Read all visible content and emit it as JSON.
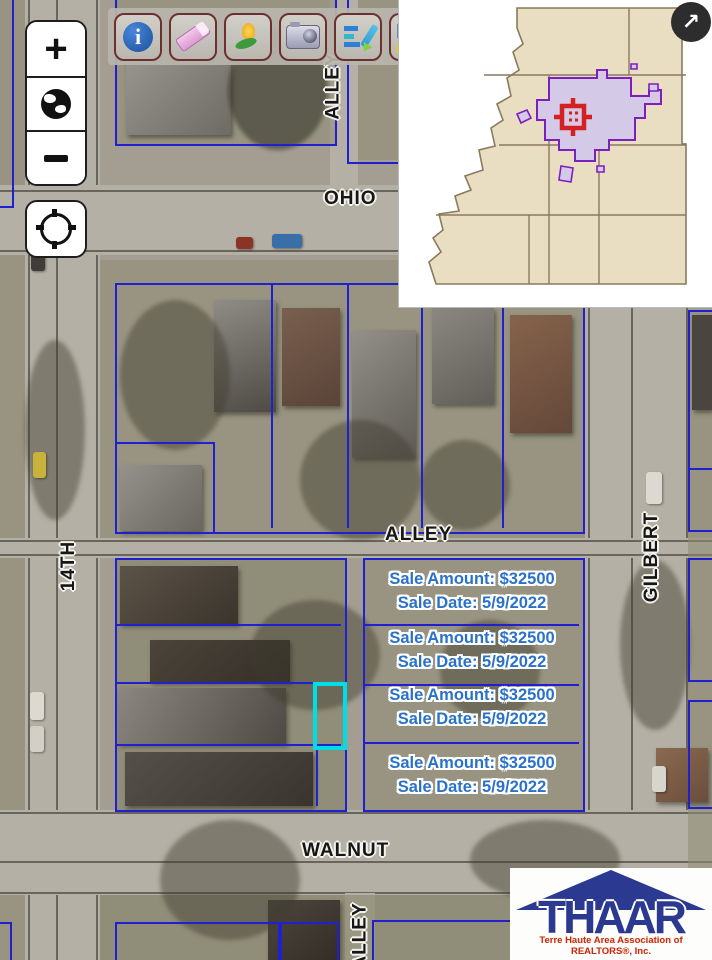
{
  "app": {
    "type": "GIS parcel map viewer",
    "region": "Terre Haute, Vigo County"
  },
  "map_controls": {
    "zoom_in_label": "+",
    "zoom_out_label": "−",
    "icons": [
      "plus-icon",
      "globe-icon",
      "minus-icon",
      "crosshair-locate-icon"
    ]
  },
  "toolbar": {
    "icons": [
      "info-icon",
      "eraser-icon",
      "flower-marker-icon",
      "camera-icon",
      "chart-edit-icon",
      "k-tool-icon"
    ],
    "k_partial_label": "K"
  },
  "overview_map": {
    "expand_arrow": "↗",
    "description": "County overview inset with township grid, highlighted city boundary and current-location marker"
  },
  "street_labels": {
    "ohio": "OHIO",
    "alley_top": "ALLEY",
    "fourteenth": "14TH",
    "alley_mid": "ALLEY",
    "gilbert": "GILBERT",
    "walnut": "WALNUT",
    "alley_bottom": "ALLEY"
  },
  "sales": [
    {
      "amount": "Sale Amount: $32500",
      "date": "Sale Date: 5/9/2022"
    },
    {
      "amount": "Sale Amount: $32500",
      "date": "Sale Date: 5/9/2022"
    },
    {
      "amount": "Sale Amount: $32500",
      "date": "Sale Date: 5/9/2022"
    },
    {
      "amount": "Sale Amount: $32500",
      "date": "Sale Date: 5/9/2022"
    }
  ],
  "logo": {
    "brand": "THAAR",
    "tagline": "Terre Haute Area Association of REALTORS®, Inc."
  },
  "colors": {
    "parcel_line": "#2020d0",
    "highlight_parcel": "#00dde6",
    "sale_text": "#2a72c9",
    "city_boundary": "#7d1fc0",
    "city_fill": "#d5c9e8",
    "marker_red": "#d42020",
    "county_fill": "#e9ddc2",
    "logo_blue": "#2b3990",
    "logo_red": "#c8281e"
  }
}
